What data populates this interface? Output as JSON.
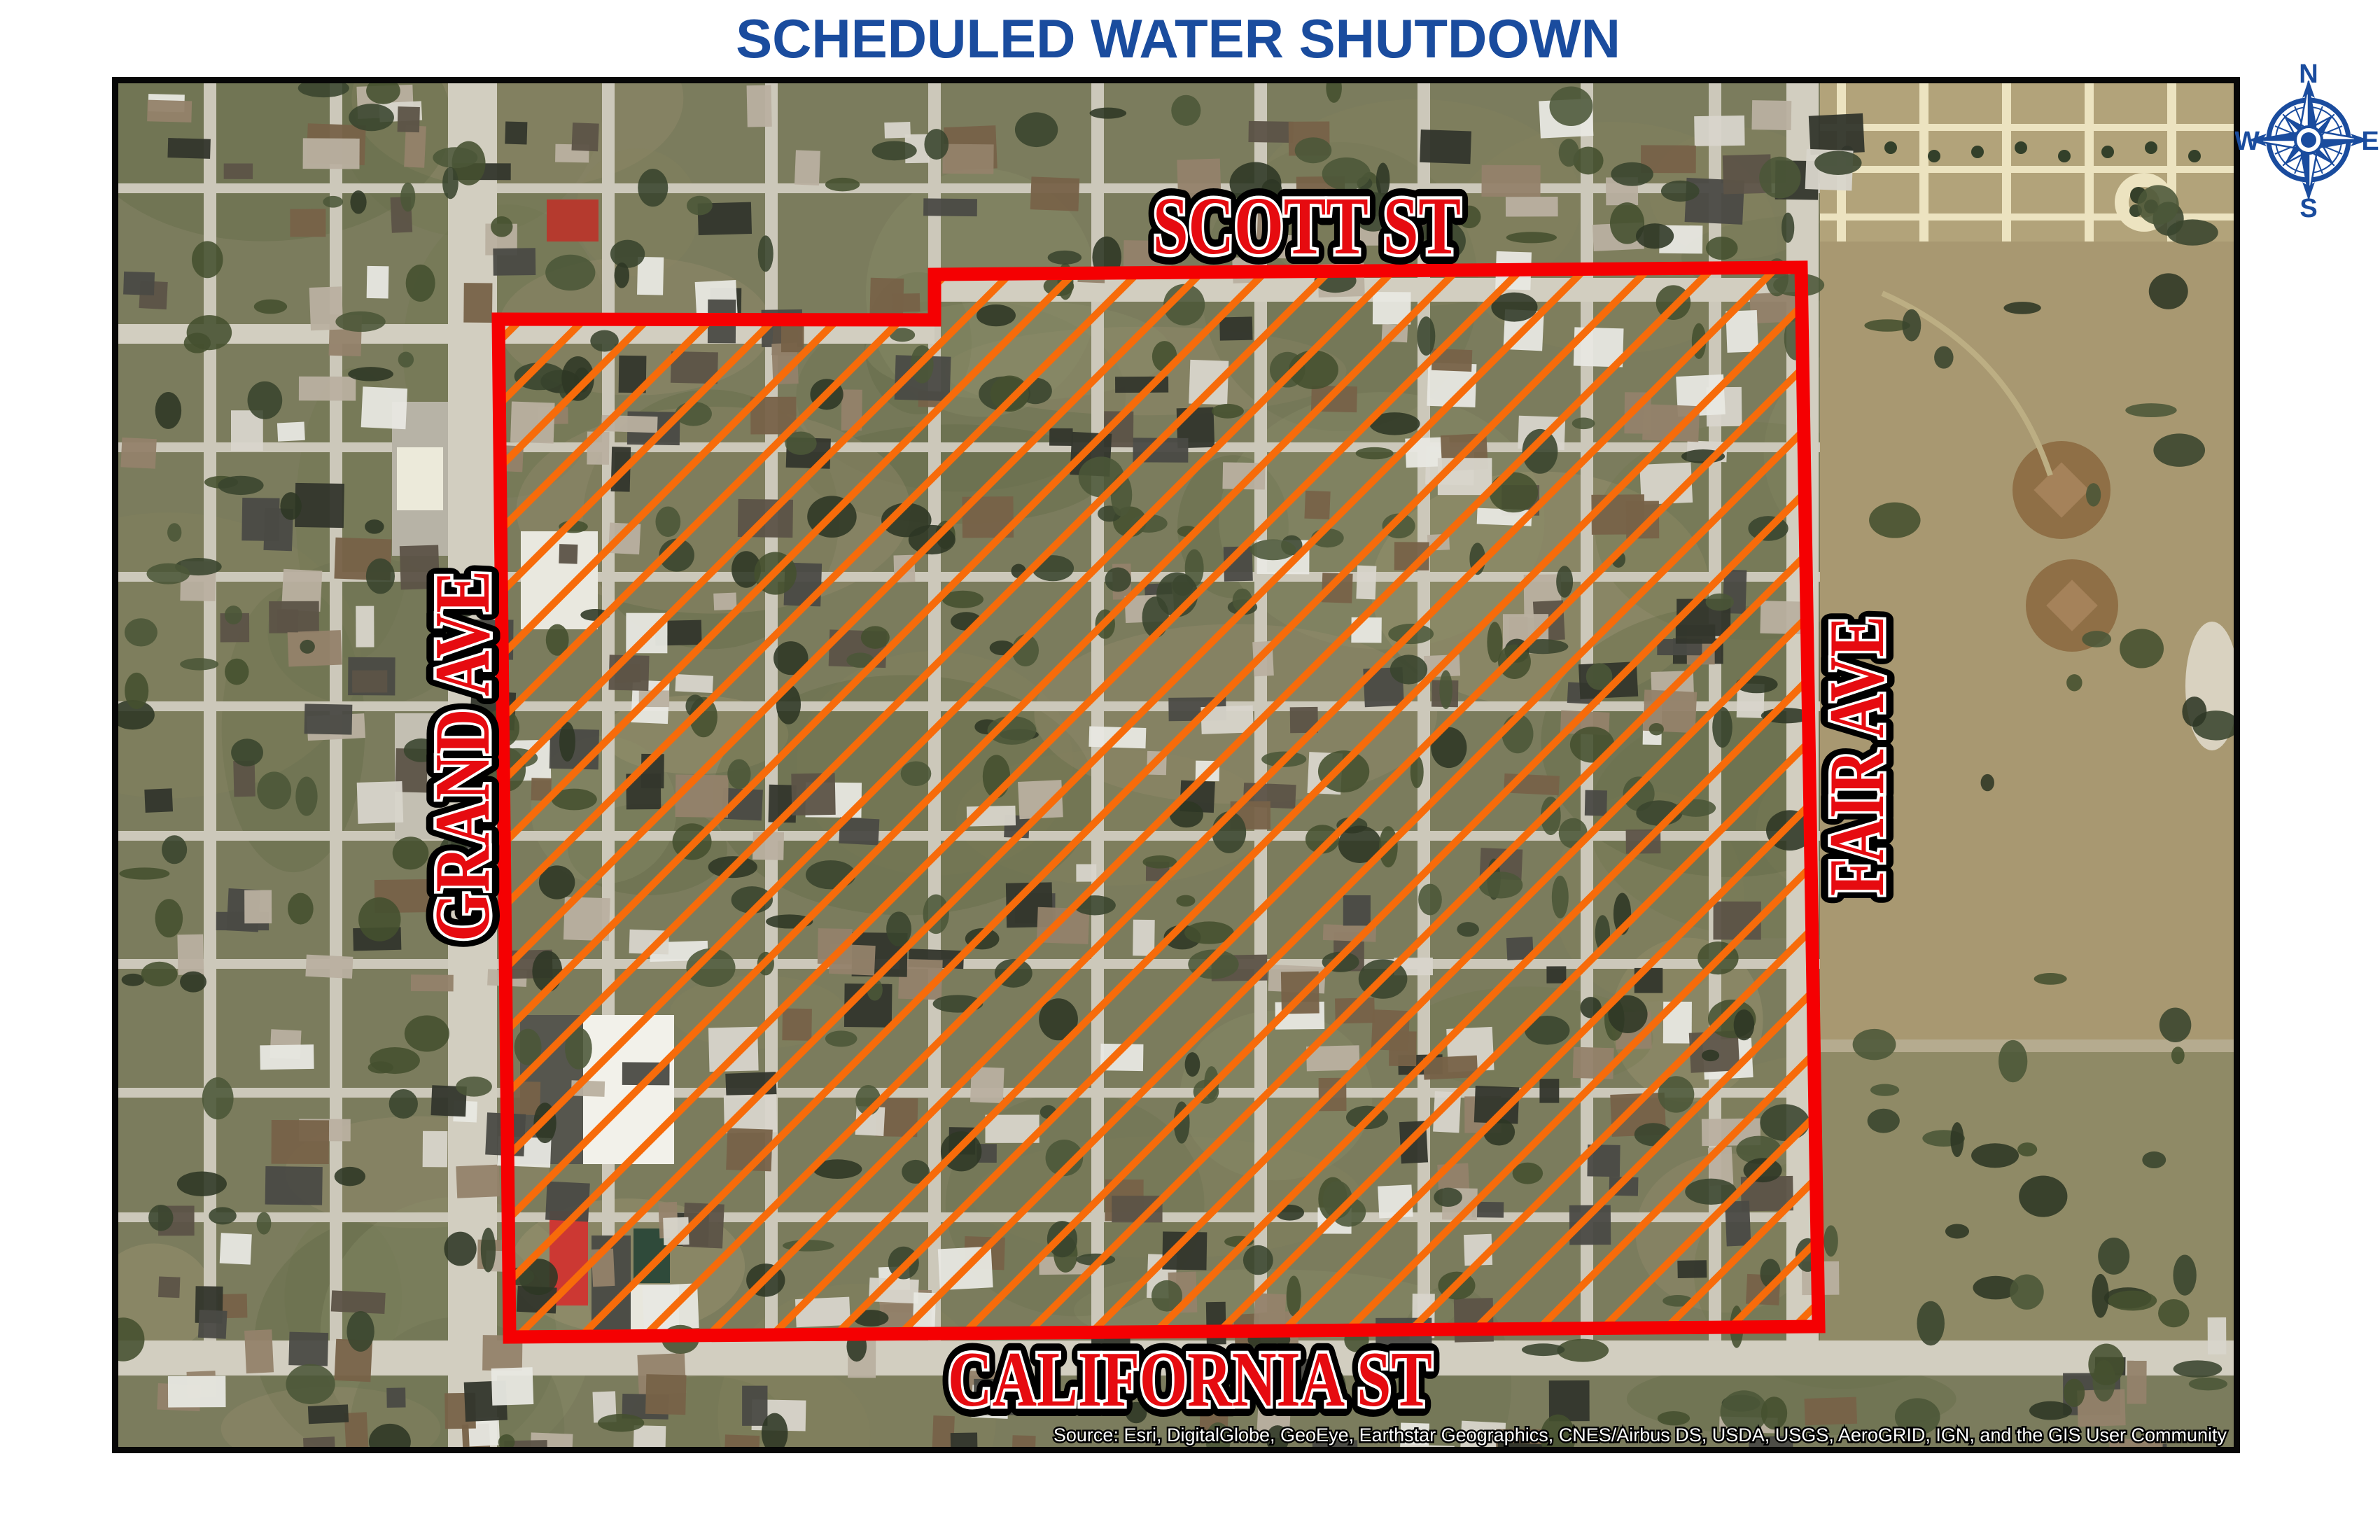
{
  "title": {
    "text": "SCHEDULED WATER SHUTDOWN",
    "color": "#1a4c9e"
  },
  "map": {
    "streets": {
      "top": "SCOTT ST",
      "left": "GRAND AVE",
      "right": "FAIR AVE",
      "bottom": "CALIFORNIA ST"
    },
    "label_style": {
      "fill": "#e60b10",
      "inner_outline": "#ffffff",
      "outer_outline": "#000000"
    },
    "shutdown_area": {
      "outline_color": "#f50002",
      "hatch_color": "#f76b0a"
    },
    "attribution": "Source: Esri, DigitalGlobe, GeoEye, Earthstar Geographics, CNES/Airbus DS, USDA, USGS, AeroGRID, IGN, and the GIS User Community"
  },
  "compass": {
    "n": "N",
    "e": "E",
    "s": "S",
    "w": "W",
    "color": "#1a4c9e"
  }
}
